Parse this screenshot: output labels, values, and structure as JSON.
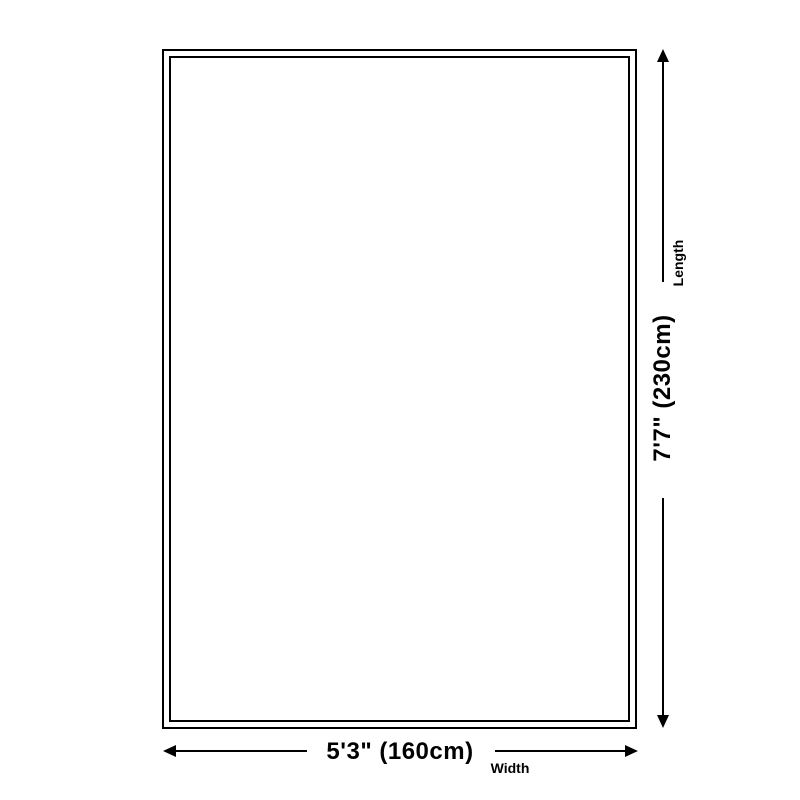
{
  "diagram": {
    "type": "rug-size-dimension-diagram",
    "background_color": "#ffffff",
    "line_color": "#000000",
    "rug": {
      "shape": "rectangle",
      "border_style": "double",
      "border_color": "#000000"
    },
    "width_dimension": {
      "value": "5'3\" (160cm)",
      "label": "Width",
      "arrow_orientation": "horizontal"
    },
    "length_dimension": {
      "value": "7'7\" (230cm)",
      "label": "Length",
      "arrow_orientation": "vertical"
    }
  }
}
